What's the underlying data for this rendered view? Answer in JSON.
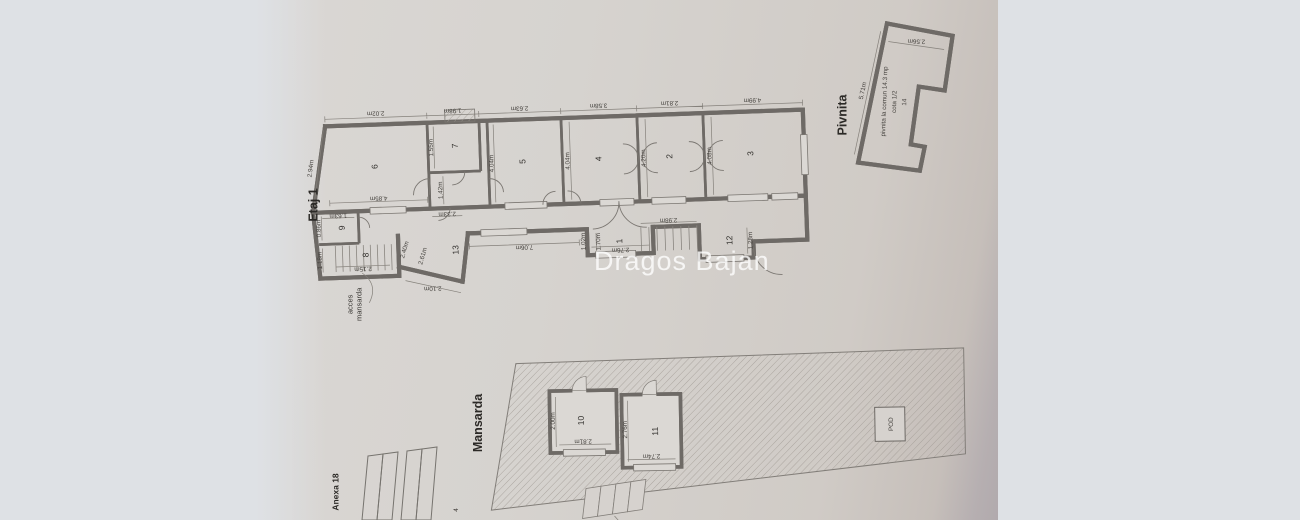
{
  "watermark": "Dragos Bajan",
  "colors": {
    "paper": "#d6d2ce",
    "ink": "#6e6a66",
    "letterbox": "#dee1e5"
  },
  "etaj1": {
    "label": "Etaj 1",
    "acces": {
      "line1": "acces",
      "line2": "mansarda"
    },
    "top_dims": [
      "2.02m",
      "1.98m",
      "2.63m",
      "3.58m",
      "2.81m",
      "4.99m"
    ],
    "left_dim": "2.94m",
    "bottom_dim_6": "4.85m",
    "outer_dim": "2.10m",
    "rooms": {
      "r6": {
        "num": "6"
      },
      "r7": {
        "num": "7",
        "side": "1.55m",
        "vest": "1.42m"
      },
      "r5": {
        "num": "5",
        "side": "4.04m"
      },
      "r4": {
        "num": "4",
        "side": "4.04m"
      },
      "r2": {
        "num": "2",
        "side": "4.20m"
      },
      "r3": {
        "num": "3",
        "side": "4.08m"
      },
      "r9": {
        "num": "9",
        "side": "0.86m",
        "top": "1.63m"
      },
      "r8": {
        "num": "8",
        "side": "1.18m",
        "stair": "2.15m",
        "wall_a": "2.40m",
        "wall_b": "2.61m"
      },
      "r13": {
        "num": "13",
        "len": "7.06m",
        "end": "1.02m",
        "seg": "2.33m"
      },
      "r1": {
        "num": "1",
        "width": "2.76m",
        "side": "1.70m"
      },
      "r12": {
        "num": "12",
        "top": "2.98m",
        "side": "1.28m"
      }
    }
  },
  "pivnita": {
    "label": "Pivnita",
    "text_line1": "pivnita la comun 14.3 mp",
    "text_line2": "cota 1/2",
    "text_line3": "14",
    "top_dim": "2.56m",
    "side_dim": "5.71m"
  },
  "mansarda": {
    "label": "Mansarda",
    "pod_label": "POD",
    "room10": {
      "num": "10",
      "width": "2.81m",
      "height": "2.00m"
    },
    "room11": {
      "num": "11",
      "width": "2.74m",
      "height": "2.76m"
    }
  },
  "anexa": {
    "label": "Anexa 18",
    "partial_dim": "4"
  }
}
